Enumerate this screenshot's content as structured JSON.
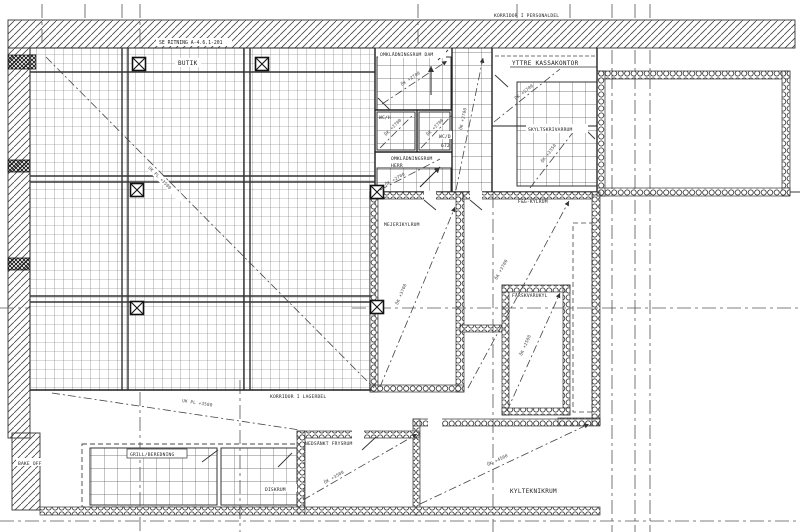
{
  "drawing": {
    "note_top": "SE RITNING A-4.6.1-201",
    "corridor_personal": "KORRIDOR I PERSONALDEL",
    "corridor_lager": "KORRIDOR I LAGERDEL",
    "rooms": {
      "butik": "BUTIK",
      "omkl_dam": "OMKLÄDNINGSRUM DAM",
      "wc_h": "WC/H",
      "wc_d": "WC/D",
      "wc_d_num": "672",
      "omkl_herr_1": "OMKLÄDNINGSRUM",
      "omkl_herr_2": "HERR",
      "yttre_kassakontor": "YTTRE KASSAKONTOR",
      "skyltskrivarrum": "SKYLTSKRIVARRUM",
      "mejerikylrum": "MEJERIKYLRUM",
      "fg_kylrum": "F&G-KYLRUM",
      "farskvarukyl": "FÄRSKVARUKYL",
      "nedsankt_frysrum": "NEDSÄNKT FRYSRUM",
      "kylteknikrum": "KYLTEKNIKRUM",
      "grill_beredning": "GRILL/BEREDNING",
      "diskrum": "DISKRUM",
      "bake_off": "BAKE OFF"
    },
    "levels": {
      "butik": "UK PL +3500",
      "lager": "UK PL +3500",
      "dam": "ÖK +2700",
      "wc_h": "ÖK +2700",
      "wc_d": "ÖK +2700",
      "herr": "ÖK +2700",
      "stair": "ÖK +2700",
      "kassa": "ÖK +2700",
      "skylt": "ÖK +2350",
      "mejeri": "ÖK +3700",
      "fg": "ÖK +3700",
      "farsk": "ÖK +2500",
      "frys": "ÖK +3500",
      "kylteknik": "ÖK +4500"
    },
    "colors": {
      "line": "#333333",
      "grid": "#666666",
      "dash": "#555555"
    }
  }
}
